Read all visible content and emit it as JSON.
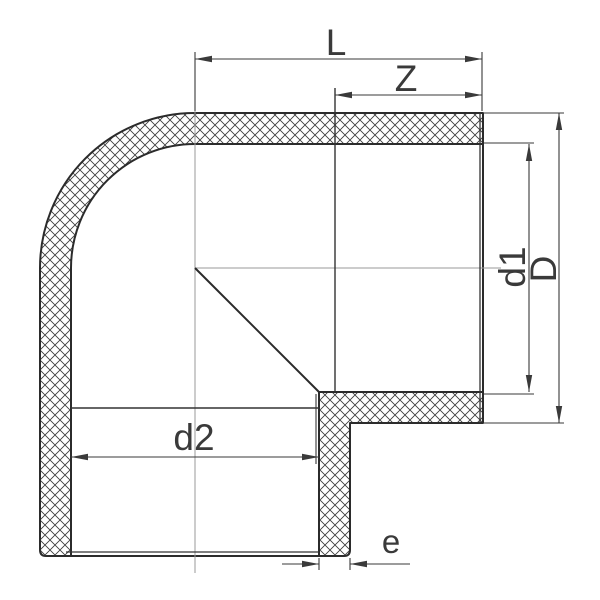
{
  "drawing": {
    "description": "Sectional technical drawing of a 90 degree socket elbow pipe fitting with crosshatched walls",
    "labels": {
      "overall_length": "L",
      "socket_depth": "Z",
      "socket_inner_diameter": "d1",
      "outer_diameter": "D",
      "bore_diameter": "d2",
      "wall_thickness": "e"
    },
    "colors": {
      "background": "#ffffff",
      "outline": "#2b2b2b",
      "hatch": "#3d3d3d",
      "dimension": "#3a3a3a",
      "centerline": "#9a9a9a"
    }
  }
}
